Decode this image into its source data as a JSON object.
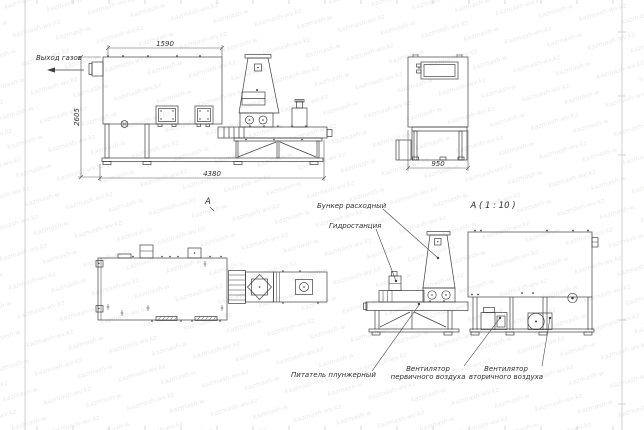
{
  "sheet": {
    "background": "#ffffff",
    "border_color": "#bdbdbd",
    "line_color": "#3f3f3f",
    "text_color": "#2e2e2e"
  },
  "watermark": {
    "text": "kazmash-wv.kz",
    "color": "#e9e9e5"
  },
  "front_view": {
    "gas_outlet_label": "Выход газов",
    "view_mark": "А",
    "dim_top": "1590",
    "dim_height": "2605",
    "dim_length": "4380"
  },
  "end_view": {
    "dim_width": "950"
  },
  "section_view": {
    "title": "А ( 1 : 10 )",
    "labels": {
      "bunker": "Бункер расходный",
      "hydrostation": "Гидростанция",
      "feeder": "Питатель плунжерный",
      "fan_primary_line1": "Вентилятор",
      "fan_primary_line2": "первичного воздуха",
      "fan_secondary_line1": "Вентилятор",
      "fan_secondary_line2": "вторичного воздуха"
    }
  }
}
